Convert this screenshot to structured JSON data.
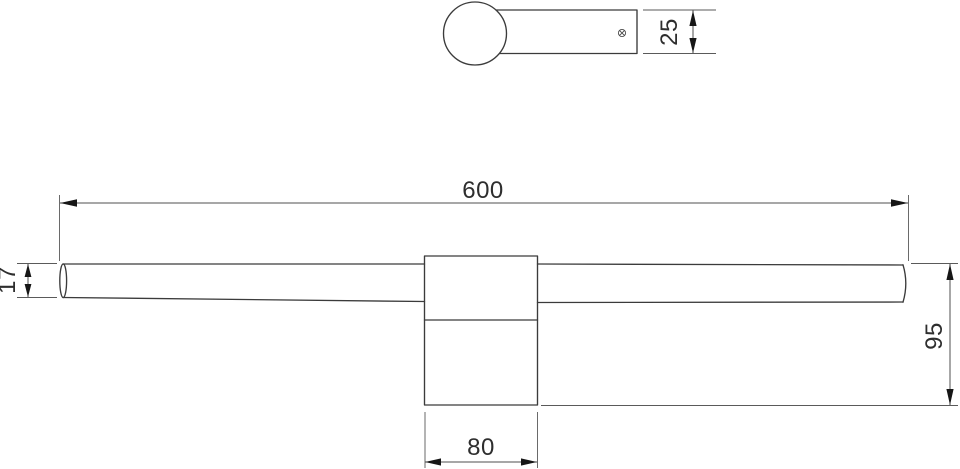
{
  "meta": {
    "subject": "wall light fixture technical dimension drawing",
    "views": [
      "top-view",
      "front-view"
    ]
  },
  "colors": {
    "background": "#ffffff",
    "object_line": "#3b3b3b",
    "dimension_line": "#4f4f4f",
    "arrow_fill": "#161616",
    "text": "#2e2e2e"
  },
  "top_view": {
    "screw_icon": {
      "name": "screw-head-icon",
      "glyph": "circle-with-cross"
    },
    "dim_arm_depth": {
      "label": "25"
    }
  },
  "front_view": {
    "dim_overall_length": {
      "label": "600"
    },
    "dim_tube_diameter": {
      "label": "17"
    },
    "dim_overall_depth": {
      "label": "95"
    },
    "dim_bracket_width": {
      "label": "80"
    }
  }
}
